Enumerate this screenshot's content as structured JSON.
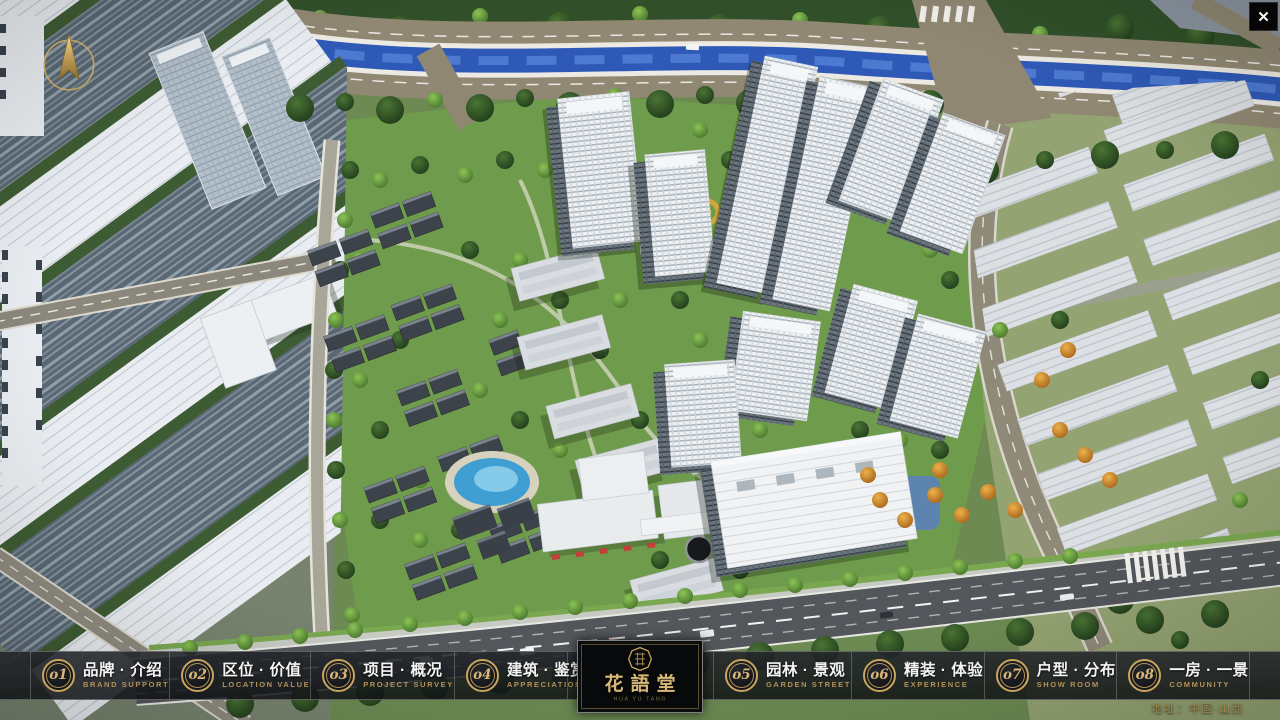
{
  "app": {
    "close_glyph": "✕"
  },
  "nav": {
    "items": [
      {
        "num": "o1",
        "zh": "品牌 · 介绍",
        "en": "BRAND SUPPORT"
      },
      {
        "num": "o2",
        "zh": "区位 · 价值",
        "en": "LOCATION VALUE"
      },
      {
        "num": "o3",
        "zh": "项目 · 概况",
        "en": "PROJECT SURVEY"
      },
      {
        "num": "o4",
        "zh": "建筑 · 鉴赏",
        "en": "APPRECIATION"
      },
      {
        "num": "o5",
        "zh": "园林 · 景观",
        "en": "GARDEN STREET"
      },
      {
        "num": "o6",
        "zh": "精装 · 体验",
        "en": "EXPERIENCE"
      },
      {
        "num": "o7",
        "zh": "户型 · 分布",
        "en": "SHOW ROOM"
      },
      {
        "num": "o8",
        "zh": "一房 · 一景",
        "en": "COMMUNITY"
      }
    ]
  },
  "logo": {
    "name": "花語堂",
    "subtitle": "HUA YU TANG"
  },
  "footer": {
    "address": "地址：中国·山西"
  },
  "colors": {
    "accent_gold": "#c9a55f",
    "bar_background": "rgba(20,22,26,0.85)",
    "chinese_text": "#f4f4f2",
    "english_text": "#bb985a",
    "river_water": "#2e59b6",
    "community_grass": "#6f9c4c",
    "asphalt_road": "#53565a",
    "riverside_road": "#8f8772"
  }
}
